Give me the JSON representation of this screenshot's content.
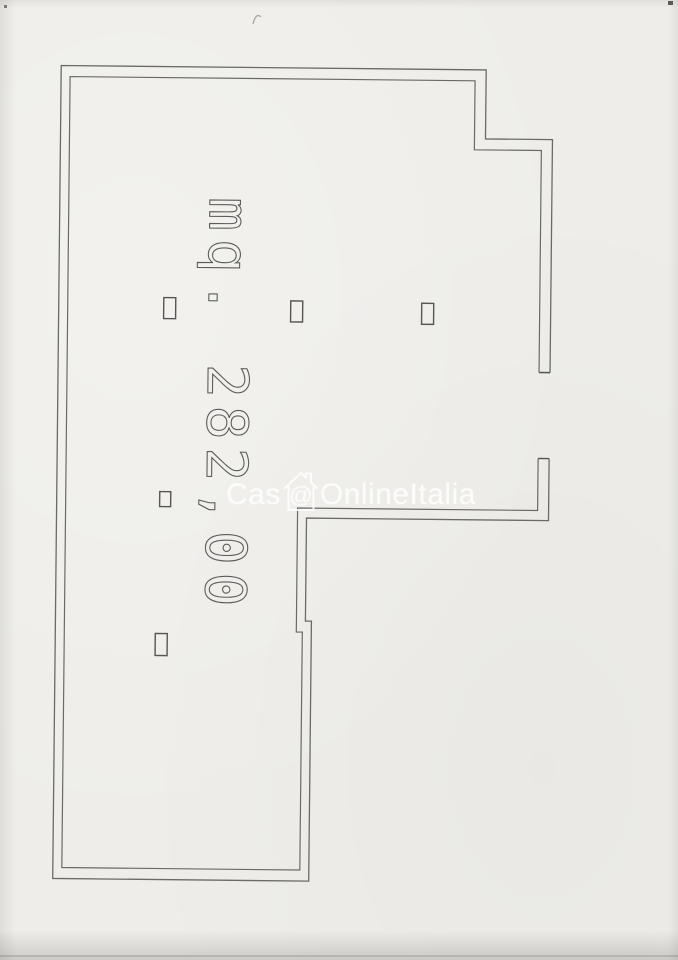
{
  "plan": {
    "area_label": "mq. 282,00",
    "line_color": "#6a6a6a",
    "marker_color": "#565656",
    "paper_color": "#eeede9"
  },
  "watermark": {
    "prefix": "Cas",
    "at_symbol": "@",
    "suffix": "OnlineItalia",
    "color": "#ffffff"
  }
}
